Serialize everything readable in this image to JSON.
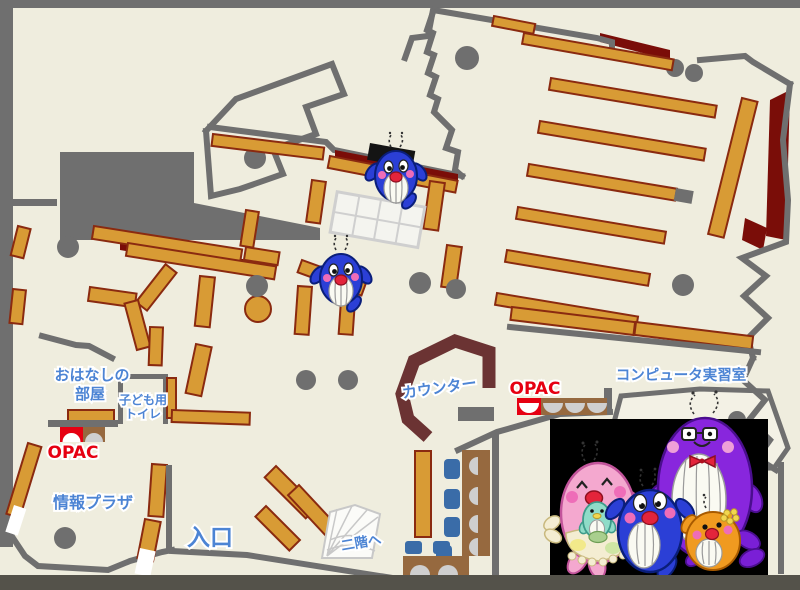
{
  "labels": {
    "storytelling_room_line1": "おはなしの",
    "storytelling_room_line2": "部屋",
    "kids_toilet_line1": "子ども用",
    "kids_toilet_line2": "トイレ",
    "opac_left": "OPAC",
    "info_plaza": "情報プラザ",
    "entrance": "入口",
    "counter": "カウンター",
    "opac_center": "OPAC",
    "computer_room": "コンピュータ実習室",
    "to_second_floor": "二階へ"
  },
  "colors": {
    "floor": "#EFEDDE",
    "wall": "#6F6F6F",
    "outer": "#54524A",
    "shelf": "#D89B35",
    "shelfStroke": "#8A2A10",
    "maroon": "#7A0D08",
    "counter": "#6B3333",
    "desk": "#96693F",
    "chair": "#3A6CA8",
    "seat": "#CFCFCF",
    "labelBlue": "#4C84D4",
    "labelRed": "#E60012",
    "tableLine": "#CFCFCF",
    "tableCell": "#F4F4EF",
    "stair": "#FBFBF8",
    "stairLine": "#C8C8C8",
    "whaleBlue": "#2B3FD6",
    "whaleStroke": "#0A1E7A",
    "pink": "#F4A8CF",
    "pinkStroke": "#C2549B",
    "purple": "#8826DD",
    "purpleStroke": "#4A0E8E",
    "orange": "#F09A20",
    "orangeStroke": "#A85A00",
    "teal": "#8FDCC8",
    "tealStroke": "#3D9B8A",
    "cream": "#F4EDD2",
    "creamStroke": "#C9B97E",
    "blush": "#EE6DB8",
    "mouth": "#E3243B",
    "mouthStroke": "#8E1020",
    "finPurple": "#7A1FD6",
    "flowerYellow": "#F2D74E",
    "flowerStroke": "#B89A2A"
  }
}
